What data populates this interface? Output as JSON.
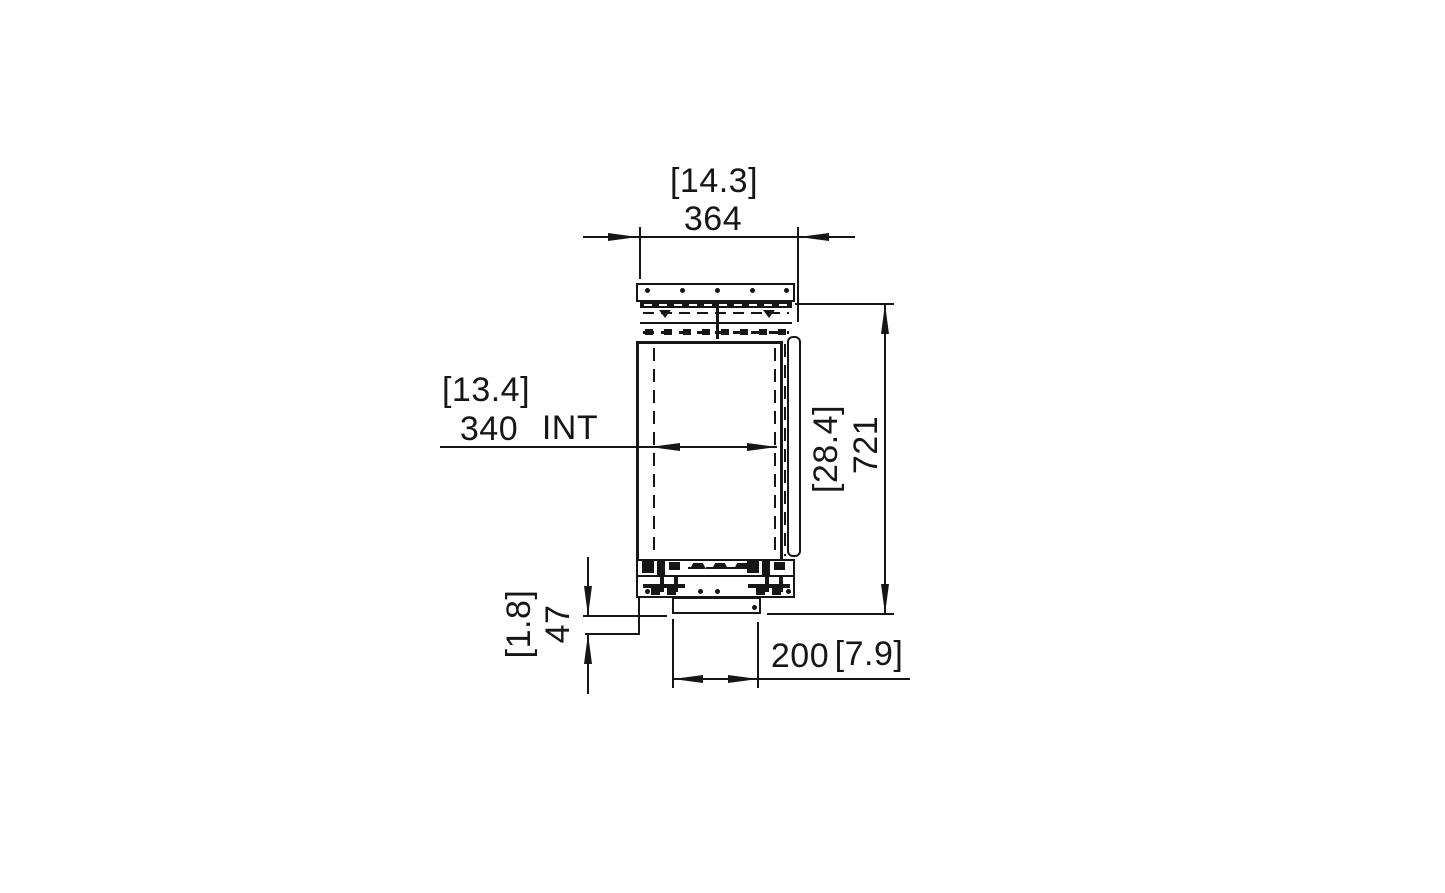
{
  "drawing": {
    "description": "Side elevation technical dimension drawing of built-in firebox unit",
    "background": "#ffffff",
    "line_color": "#161616",
    "dimensions": {
      "overall_width": {
        "metric": "364",
        "imperial": "[14.3]"
      },
      "internal_width": {
        "metric": "340",
        "imperial": "[13.4]",
        "note": "INT"
      },
      "overall_height": {
        "metric": "721",
        "imperial": "[28.4]"
      },
      "base_drop": {
        "metric": "47",
        "imperial": "[1.8]"
      },
      "tray_width": {
        "metric": "200",
        "imperial": "[7.9]"
      }
    }
  }
}
